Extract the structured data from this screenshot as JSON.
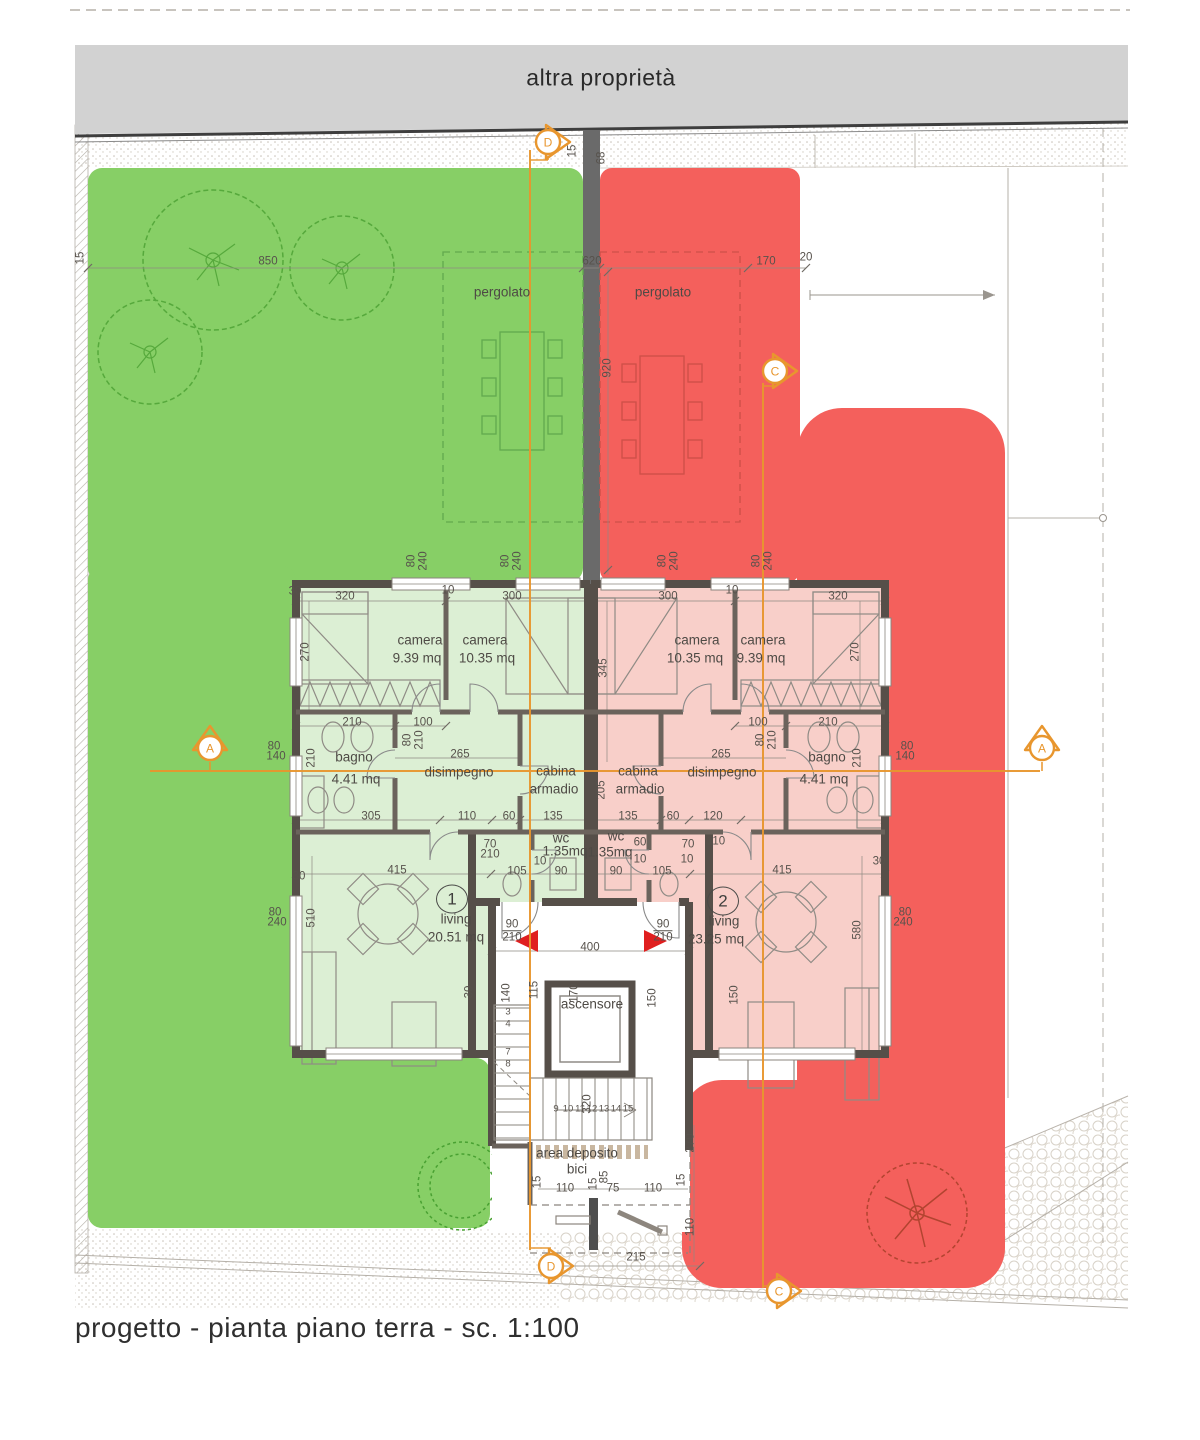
{
  "neighbor_band": {
    "label": "altra proprietà"
  },
  "title_block": {
    "text": "progetto - pianta piano terra - sc. 1:100"
  },
  "colors": {
    "garden_green": "#87cf66",
    "garden_red": "#f4605c",
    "room_green": "#dcefd4",
    "room_red": "#f8cfc9",
    "wall": "#564f49",
    "band_gray": "#d2d2d2",
    "section_orange": "#e8962e",
    "entry_red": "#e01f1f"
  },
  "section_markers": [
    {
      "letter": "D"
    },
    {
      "letter": "D"
    },
    {
      "letter": "C"
    },
    {
      "letter": "C"
    },
    {
      "letter": "A"
    },
    {
      "letter": "A"
    }
  ],
  "unit_badges": [
    {
      "n": "1",
      "x": 452,
      "y": 899
    },
    {
      "n": "2",
      "x": 723,
      "y": 901
    }
  ],
  "labels": {
    "rooms": [
      [
        "pergolato",
        502,
        292
      ],
      [
        "pergolato",
        663,
        292
      ],
      [
        "camera",
        420,
        640
      ],
      [
        "9.39 mq",
        417,
        658
      ],
      [
        "camera",
        485,
        640
      ],
      [
        "10.35 mq",
        487,
        658
      ],
      [
        "camera",
        697,
        640
      ],
      [
        "10.35 mq",
        695,
        658
      ],
      [
        "camera",
        763,
        640
      ],
      [
        "9.39 mq",
        761,
        658
      ],
      [
        "bagno",
        354,
        757
      ],
      [
        "4.41 mq",
        356,
        779
      ],
      [
        "bagno",
        827,
        757
      ],
      [
        "4.41 mq",
        824,
        779
      ],
      [
        "disimpegno",
        459,
        772
      ],
      [
        "disimpegno",
        722,
        772
      ],
      [
        "cabina",
        556,
        771
      ],
      [
        "armadio",
        554,
        789
      ],
      [
        "cabina",
        638,
        771
      ],
      [
        "armadio",
        640,
        789
      ],
      [
        "wc",
        561,
        838
      ],
      [
        "1.35mq",
        565,
        851
      ],
      [
        "wc",
        616,
        836
      ],
      [
        "1.35mq",
        610,
        852
      ],
      [
        "living",
        456,
        919
      ],
      [
        "20.51 mq",
        456,
        937
      ],
      [
        "living",
        724,
        921
      ],
      [
        "23.25 mq",
        716,
        939
      ],
      [
        "ascensore",
        592,
        1004
      ],
      [
        "area deposito",
        577,
        1153
      ],
      [
        "bici",
        577,
        1169
      ]
    ],
    "dims": [
      [
        "850",
        268,
        262
      ],
      [
        "15",
        81,
        258,
        -90
      ],
      [
        "620",
        592,
        262
      ],
      [
        "920",
        608,
        368,
        -90
      ],
      [
        "170",
        766,
        262
      ],
      [
        "20",
        806,
        258
      ],
      [
        "15",
        573,
        151,
        -90
      ],
      [
        "68",
        602,
        158,
        -90
      ],
      [
        "30",
        295,
        592
      ],
      [
        "320",
        345,
        597
      ],
      [
        "300",
        512,
        597
      ],
      [
        "300",
        668,
        597
      ],
      [
        "320",
        838,
        597
      ],
      [
        "10",
        448,
        591
      ],
      [
        "10",
        732,
        591
      ],
      [
        "270",
        306,
        652,
        -90
      ],
      [
        "270",
        856,
        652,
        -90
      ],
      [
        "345",
        604,
        668,
        -90
      ],
      [
        "210",
        352,
        723
      ],
      [
        "100",
        423,
        723
      ],
      [
        "100",
        758,
        723
      ],
      [
        "210",
        828,
        723
      ],
      [
        "265",
        460,
        755
      ],
      [
        "265",
        721,
        755
      ],
      [
        "80",
        408,
        740,
        -90
      ],
      [
        "210",
        420,
        740,
        -90
      ],
      [
        "80",
        761,
        740,
        -90
      ],
      [
        "210",
        773,
        740,
        -90
      ],
      [
        "80",
        412,
        561,
        -90
      ],
      [
        "240",
        424,
        561,
        -90
      ],
      [
        "80",
        506,
        561,
        -90
      ],
      [
        "240",
        518,
        561,
        -90
      ],
      [
        "80",
        663,
        561,
        -90
      ],
      [
        "240",
        675,
        561,
        -90
      ],
      [
        "80",
        757,
        561,
        -90
      ],
      [
        "240",
        769,
        561,
        -90
      ],
      [
        "80",
        274,
        747
      ],
      [
        "140",
        276,
        757
      ],
      [
        "80",
        907,
        747
      ],
      [
        "140",
        905,
        757
      ],
      [
        "205",
        602,
        790,
        -90
      ],
      [
        "210",
        312,
        758,
        -90
      ],
      [
        "210",
        858,
        758,
        -90
      ],
      [
        "305",
        371,
        817
      ],
      [
        "110",
        467,
        817
      ],
      [
        "60",
        509,
        817
      ],
      [
        "135",
        553,
        817
      ],
      [
        "135",
        628,
        817
      ],
      [
        "60",
        673,
        817
      ],
      [
        "120",
        713,
        817
      ],
      [
        "110",
        716,
        842
      ],
      [
        "70",
        490,
        845
      ],
      [
        "210",
        490,
        855
      ],
      [
        "70",
        688,
        845
      ],
      [
        "60",
        640,
        843
      ],
      [
        "10",
        540,
        862
      ],
      [
        "10",
        640,
        860
      ],
      [
        "10",
        687,
        860
      ],
      [
        "105",
        517,
        872
      ],
      [
        "90",
        561,
        872
      ],
      [
        "90",
        616,
        872
      ],
      [
        "105",
        662,
        872
      ],
      [
        "415",
        397,
        871
      ],
      [
        "415",
        782,
        871
      ],
      [
        "30",
        299,
        877
      ],
      [
        "30",
        879,
        862
      ],
      [
        "510",
        312,
        918,
        -90
      ],
      [
        "580",
        858,
        930,
        -90
      ],
      [
        "80",
        275,
        913
      ],
      [
        "240",
        277,
        923
      ],
      [
        "80",
        905,
        913
      ],
      [
        "240",
        903,
        923
      ],
      [
        "400",
        590,
        948
      ],
      [
        "90",
        512,
        925
      ],
      [
        "210",
        512,
        937,
        0,
        "ovl"
      ],
      [
        "90",
        663,
        925
      ],
      [
        "210",
        663,
        937,
        0,
        "ovl"
      ],
      [
        "140",
        507,
        993,
        -90
      ],
      [
        "115",
        535,
        990,
        -90
      ],
      [
        "170",
        575,
        993,
        -90
      ],
      [
        "150",
        653,
        998,
        -90
      ],
      [
        "150",
        735,
        995,
        -90
      ],
      [
        "30",
        470,
        992,
        -90
      ],
      [
        "320",
        588,
        1104,
        -90
      ],
      [
        "15",
        538,
        1182,
        -90
      ],
      [
        "110",
        565,
        1189
      ],
      [
        "15",
        594,
        1184,
        -90
      ],
      [
        "85",
        605,
        1177,
        -90
      ],
      [
        "75",
        613,
        1189
      ],
      [
        "110",
        653,
        1189
      ],
      [
        "15",
        682,
        1180,
        -90
      ],
      [
        "270",
        691,
        1143,
        -90
      ],
      [
        "110",
        691,
        1227,
        -90
      ],
      [
        "215",
        636,
        1258
      ]
    ],
    "stair_numbers": [
      [
        "3",
        508,
        1012
      ],
      [
        "4",
        508,
        1024
      ],
      [
        "7",
        508,
        1052
      ],
      [
        "8",
        508,
        1064
      ],
      [
        "9",
        556,
        1109
      ],
      [
        "10",
        568,
        1109
      ],
      [
        "11",
        580,
        1109
      ],
      [
        "12",
        592,
        1109
      ],
      [
        "13",
        604,
        1109
      ],
      [
        "14",
        616,
        1109
      ],
      [
        "15",
        628,
        1109
      ]
    ]
  }
}
